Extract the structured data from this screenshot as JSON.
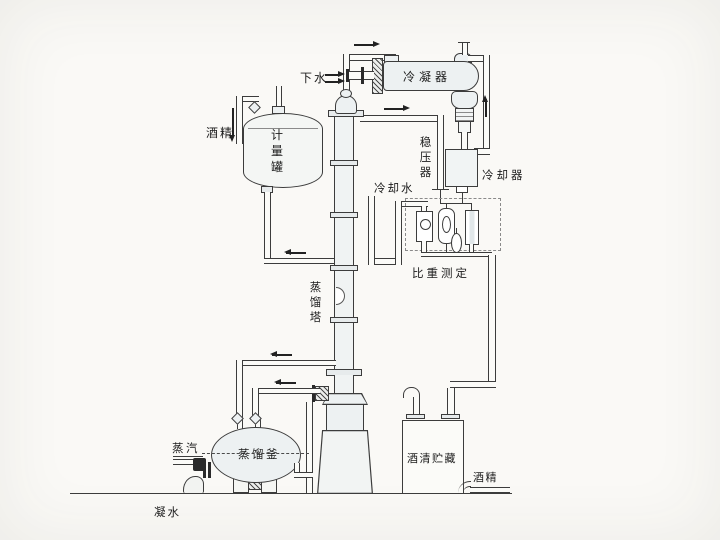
{
  "diagram": {
    "type": "alcohol-distillation-process-flow-diagram",
    "labels": {
      "down_water": "下水",
      "condenser": "冷凝器",
      "alcohol_feed": "酒精",
      "metering_tank": "计量罐",
      "pressure_stabilizer": "稳压器",
      "cooling_water": "冷却水",
      "cooler": "冷却器",
      "distillation_column": "蒸馏塔",
      "gravity_measurement": "比重测定",
      "steam": "蒸汽",
      "distillation_kettle": "蒸馏釜",
      "spirit_storage": "酒清贮藏",
      "alcohol_out": "酒精",
      "condensate_water": "凝水"
    },
    "colors": {
      "background": "#faf9f6",
      "line": "#3c3c3c",
      "vessel_fill": "#edf1f2",
      "valve_fill": "#2a2a2a"
    }
  }
}
